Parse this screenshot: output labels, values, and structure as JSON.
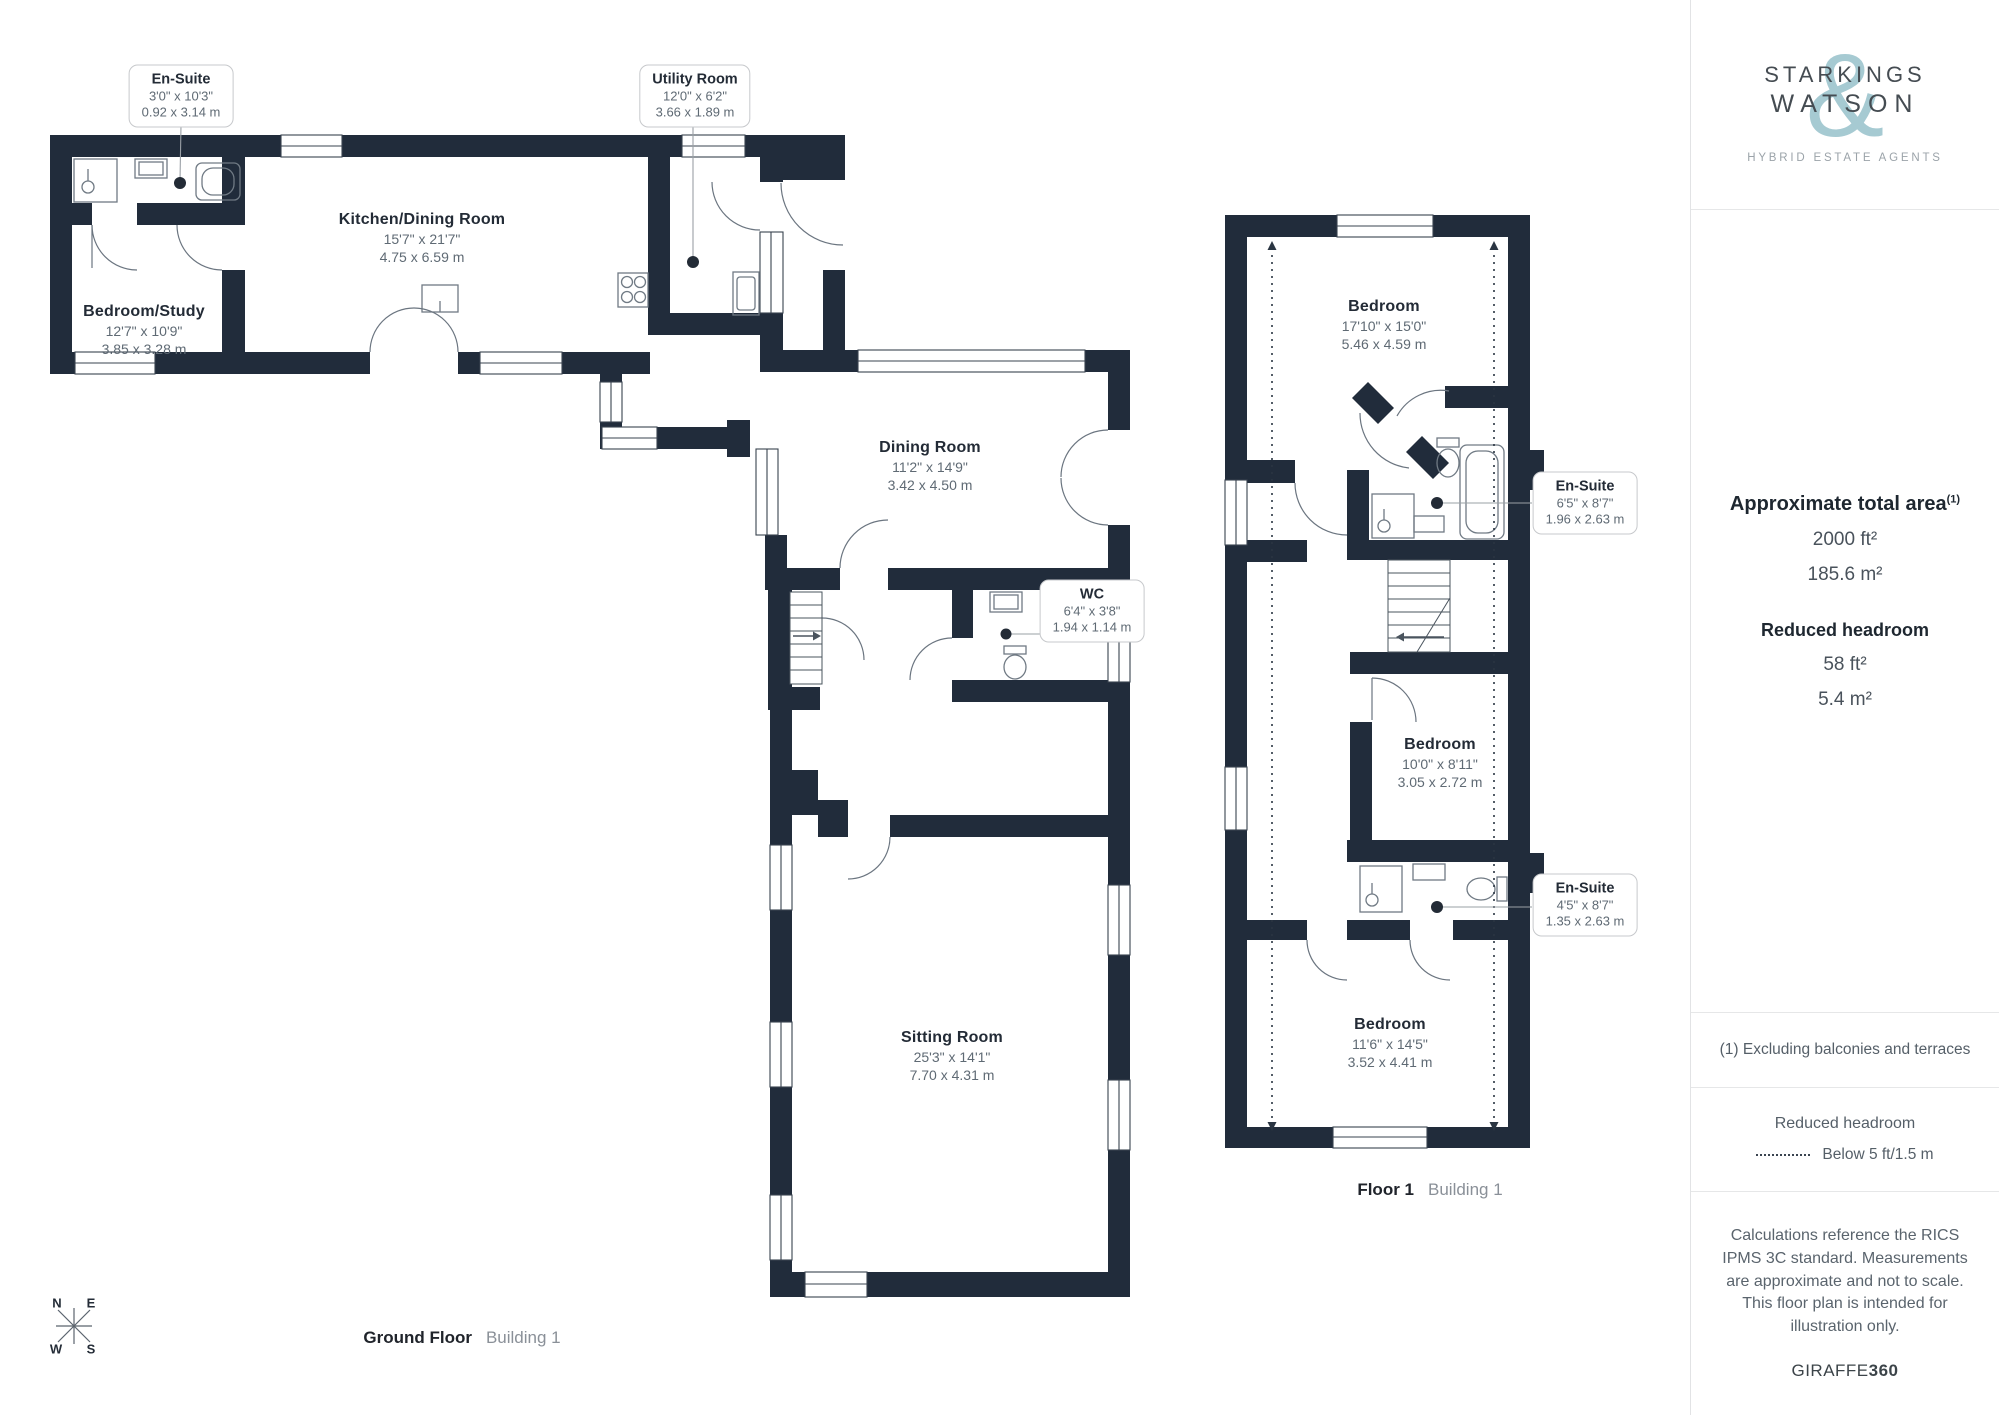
{
  "branding": {
    "line1": "STARKINGS",
    "amp": "&",
    "line2": "WATSON",
    "tagline": "HYBRID ESTATE AGENTS"
  },
  "sidebar": {
    "area_title": "Approximate total area",
    "area_sup": "(1)",
    "area_ft": "2000 ft²",
    "area_m": "185.6 m²",
    "headroom_title": "Reduced headroom",
    "headroom_ft": "58 ft²",
    "headroom_m": "5.4 m²",
    "footnote": "(1) Excluding balconies and terraces",
    "legend_title": "Reduced headroom",
    "legend_label": "Below 5 ft/1.5 m",
    "disclaimer": "Calculations reference the RICS IPMS 3C standard. Measurements are approximate and not to scale. This floor plan is intended for illustration only.",
    "brand_word": "GIRAFFE",
    "brand_num": "360"
  },
  "floors": [
    {
      "name": "Ground Floor",
      "building": "Building 1"
    },
    {
      "name": "Floor 1",
      "building": "Building 1"
    }
  ],
  "compass": {
    "n": "N",
    "e": "E",
    "s": "S",
    "w": "W"
  },
  "rooms": [
    {
      "name": "Kitchen/Dining Room",
      "imperial": "15'7\" x 21'7\"",
      "metric": "4.75 x 6.59 m"
    },
    {
      "name": "Bedroom/Study",
      "imperial": "12'7\" x 10'9\"",
      "metric": "3.85 x 3.28 m"
    },
    {
      "name": "Dining Room",
      "imperial": "11'2\" x 14'9\"",
      "metric": "3.42 x 4.50 m"
    },
    {
      "name": "Sitting Room",
      "imperial": "25'3\" x 14'1\"",
      "metric": "7.70 x 4.31 m"
    },
    {
      "name": "Bedroom",
      "imperial": "17'10\" x 15'0\"",
      "metric": "5.46 x 4.59 m"
    },
    {
      "name": "Bedroom",
      "imperial": "10'0\" x 8'11\"",
      "metric": "3.05 x 2.72 m"
    },
    {
      "name": "Bedroom",
      "imperial": "11'6\" x 14'5\"",
      "metric": "3.52 x 4.41 m"
    }
  ],
  "callouts": [
    {
      "title": "En-Suite",
      "imperial": "3'0\" x 10'3\"",
      "metric": "0.92 x 3.14 m"
    },
    {
      "title": "Utility Room",
      "imperial": "12'0\" x 6'2\"",
      "metric": "3.66 x 1.89 m"
    },
    {
      "title": "WC",
      "imperial": "6'4\" x 3'8\"",
      "metric": "1.94 x 1.14 m"
    },
    {
      "title": "En-Suite",
      "imperial": "6'5\" x 8'7\"",
      "metric": "1.96 x 2.63 m"
    },
    {
      "title": "En-Suite",
      "imperial": "4'5\" x 8'7\"",
      "metric": "1.35 x 2.63 m"
    }
  ]
}
